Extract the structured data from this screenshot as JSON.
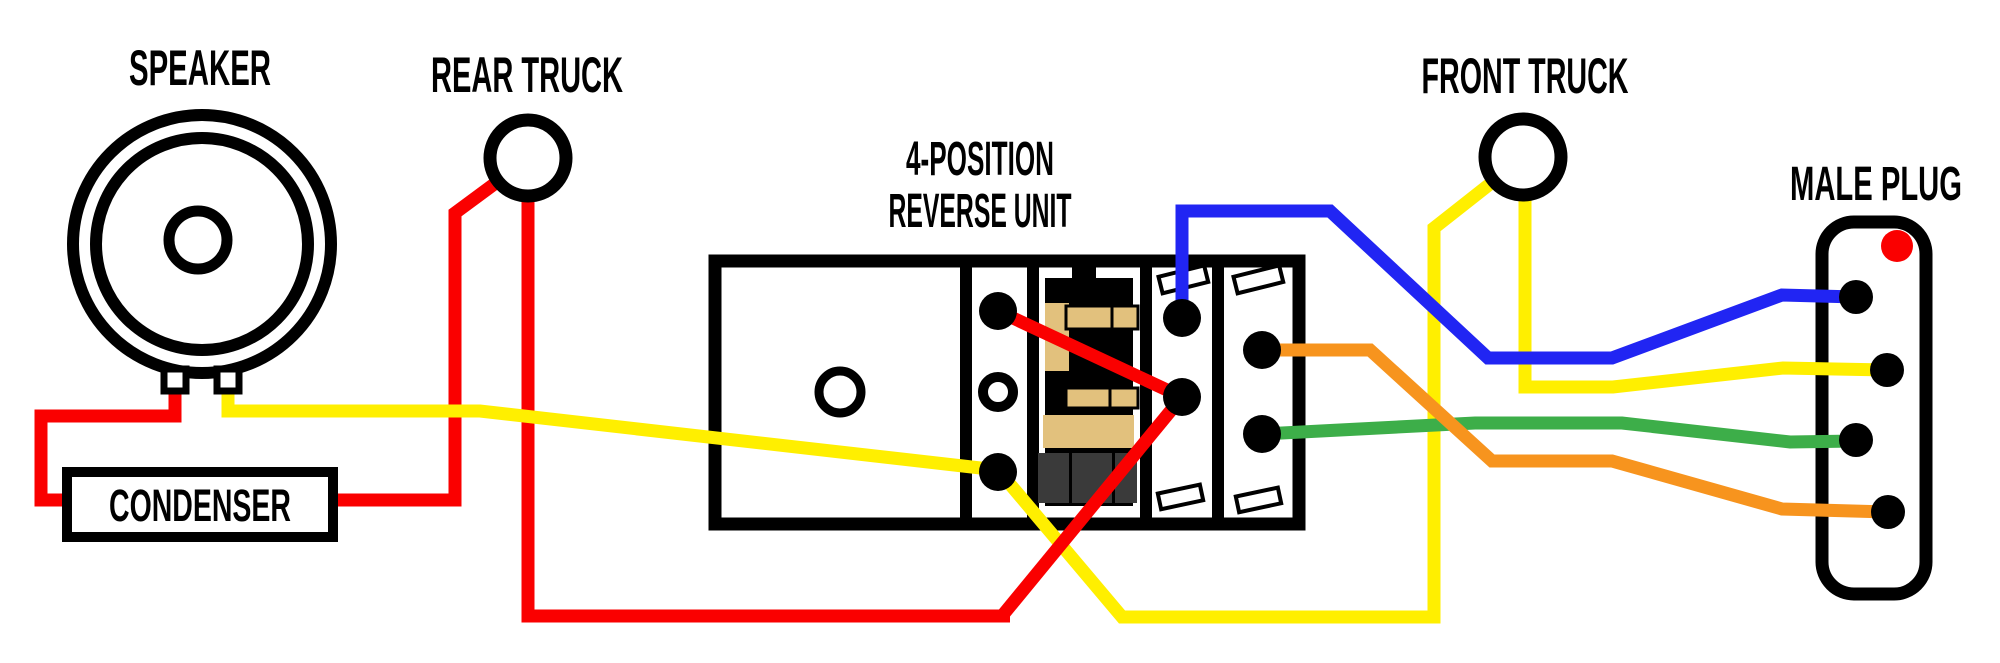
{
  "labels": {
    "speaker": "SPEAKER",
    "rear_truck": "REAR TRUCK",
    "front_truck": "FRONT TRUCK",
    "reverse_unit_line1": "4-POSITION",
    "reverse_unit_line2": "REVERSE UNIT",
    "condenser": "CONDENSER",
    "male_plug": "MALE PLUG"
  },
  "colors": {
    "red": "#FA0000",
    "yellow": "#FFEF00",
    "blue": "#2125F3",
    "green": "#3DAE49",
    "orange": "#F7941E",
    "black": "#000000",
    "white": "#FFFFFF",
    "tan": "#E2C17D",
    "coil_dark": "#3A3A3A",
    "plug_indicator": "#FA0000"
  },
  "wires": [
    {
      "id": "red-speaker-to-condenser",
      "color": "red",
      "from": "speaker left terminal",
      "to": "condenser left side"
    },
    {
      "id": "red-condenser-to-rear-truck",
      "color": "red",
      "from": "condenser right side",
      "to": "rear truck"
    },
    {
      "id": "red-rear-truck-to-reverse-unit",
      "color": "red",
      "from": "rear truck",
      "to": "reverse unit junction terminal"
    },
    {
      "id": "red-reverse-unit-internal",
      "color": "red",
      "from": "reverse unit strip top terminal",
      "to": "reverse unit junction terminal"
    },
    {
      "id": "yellow-speaker-to-reverse-unit",
      "color": "yellow",
      "from": "speaker right terminal",
      "to": "reverse unit strip bottom terminal"
    },
    {
      "id": "yellow-reverse-unit-to-front-truck",
      "color": "yellow",
      "from": "reverse unit strip bottom terminal",
      "to": "front truck"
    },
    {
      "id": "yellow-front-truck-to-plug-pin-2",
      "color": "yellow",
      "from": "front truck",
      "to": "male plug pin 2"
    },
    {
      "id": "blue-reverse-unit-to-plug-pin-1",
      "color": "blue",
      "from": "reverse unit blue terminal",
      "to": "male plug pin 1"
    },
    {
      "id": "green-reverse-unit-to-plug-pin-3",
      "color": "green",
      "from": "reverse unit lower output terminal",
      "to": "male plug pin 3"
    },
    {
      "id": "orange-reverse-unit-to-plug-pin-4",
      "color": "orange",
      "from": "reverse unit upper output terminal",
      "to": "male plug pin 4"
    }
  ],
  "plug": {
    "pin_count": "4"
  }
}
